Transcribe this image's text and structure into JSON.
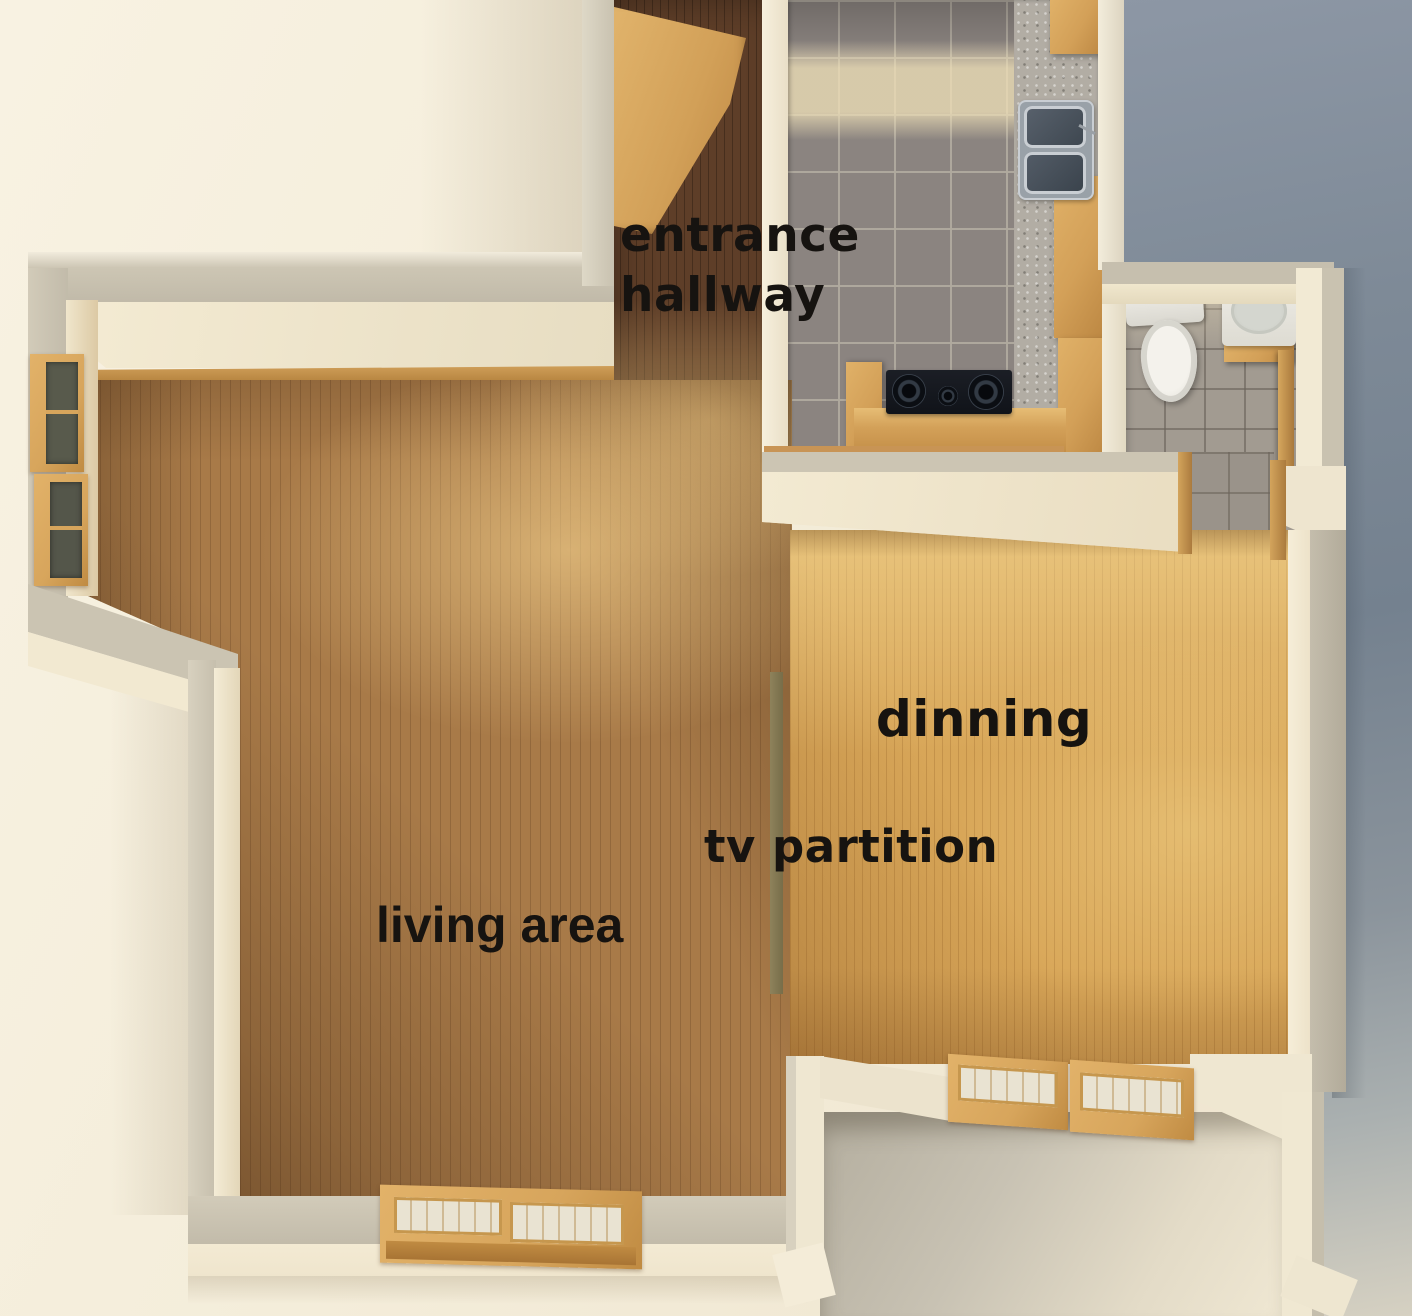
{
  "scene": {
    "title": "apartment floor plan - 3D top-down render",
    "labels": {
      "entrance_hallway": {
        "line1": "entrance",
        "line2": "hallway"
      },
      "dining": "dinning",
      "tv_partition": "tv partition",
      "living_area": "living area"
    },
    "rooms": [
      "entrance hallway",
      "kitchen",
      "bathroom",
      "dinning",
      "living area",
      "balcony"
    ],
    "fixtures": [
      "entrance-door",
      "kitchen-counter",
      "kitchen-sink",
      "cooktop",
      "kitchen-cabinets",
      "toilet",
      "bathroom-sink",
      "bathroom-door",
      "tv-partition",
      "left-wall-windows",
      "bottom-wall-window",
      "balcony-windows"
    ],
    "colors": {
      "exterior_ground": "#f4edda",
      "exterior_right": "#74818f",
      "wall_cream": "#efe7d1",
      "wall_top_gray": "#c6bfad",
      "hallway_wood": "#5e3e28",
      "living_wood": "#a87a48",
      "dining_wood": "#d8a658",
      "kitchen_tile": "#8b8480",
      "bathroom_tile": "#a29b91",
      "counter_wood": "#d3a058",
      "granite": "#b2ada4",
      "partition_olive": "#847a55",
      "label_text": "#161310"
    }
  }
}
